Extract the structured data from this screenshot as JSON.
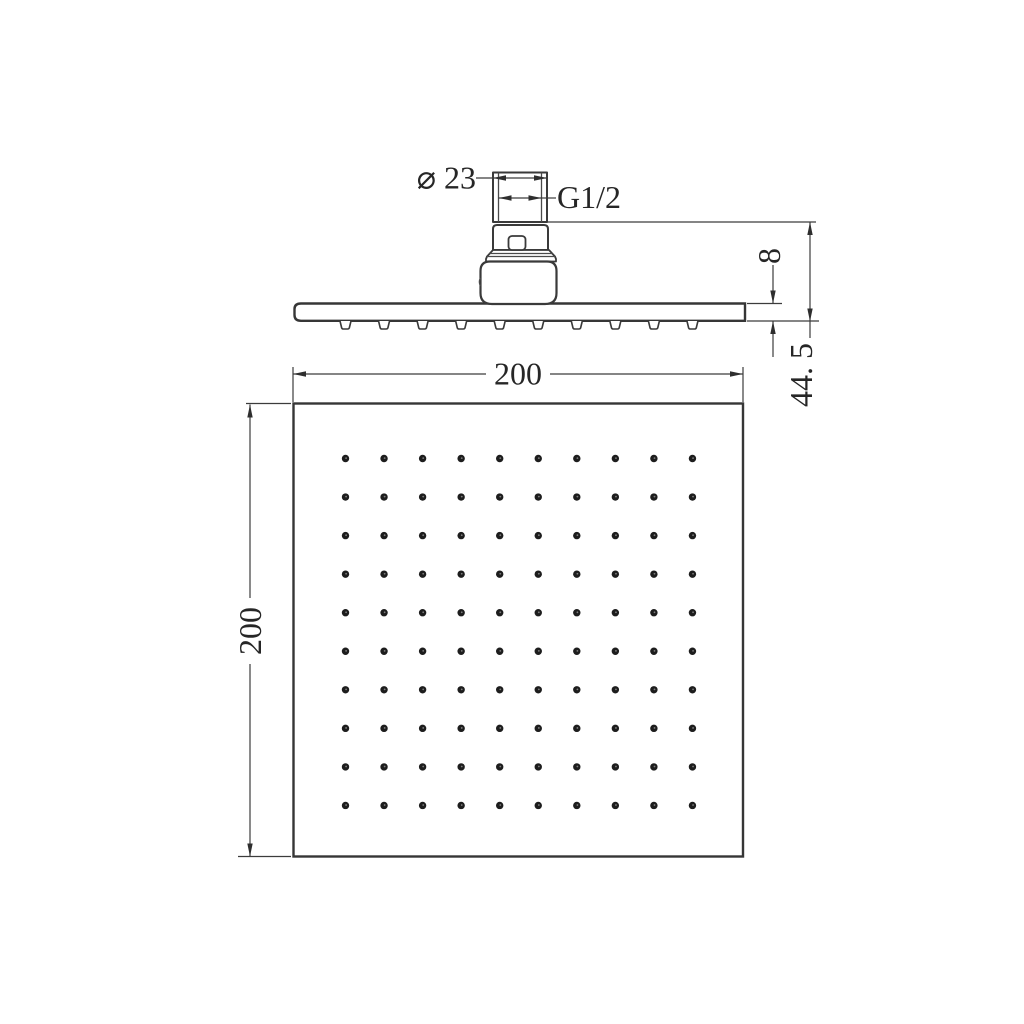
{
  "drawing": {
    "background": "#ffffff",
    "line_color": "#3a3a3a",
    "text_color": "#262626",
    "labels": {
      "inlet_diameter": "⌀ 23",
      "thread_size": "G1/2",
      "face_thickness": "8",
      "overall_height": "44. 5",
      "face_width": "200",
      "face_height": "200"
    },
    "nozzles": {
      "grid_rows": 10,
      "grid_cols": 10,
      "side_view_count": 10
    }
  }
}
